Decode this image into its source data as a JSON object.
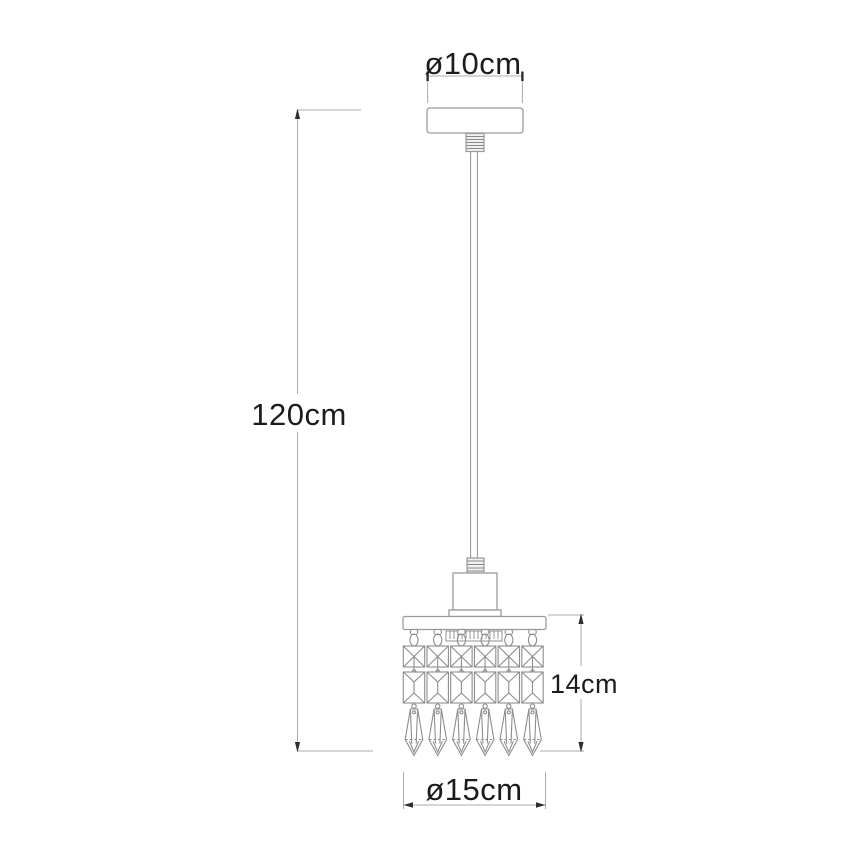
{
  "diagram": {
    "kind": "technical-dimension-drawing",
    "subject": "crystal pendant ceiling lamp",
    "crystal_strand_count": 6,
    "crystals_per_strand": 3,
    "labels": {
      "canopy_diameter": "ø10cm",
      "pendant_height": "120cm",
      "crystal_shade_height": "14cm",
      "crystal_shade_diameter": "ø15cm"
    },
    "colors": {
      "background": "#ffffff",
      "outline": "#9a9a9a",
      "crystal_outline": "#8d8d8d",
      "dimension_line": "#ababab",
      "dimension_text": "#1c1c1c",
      "arrow": "#2e2e2e"
    }
  }
}
